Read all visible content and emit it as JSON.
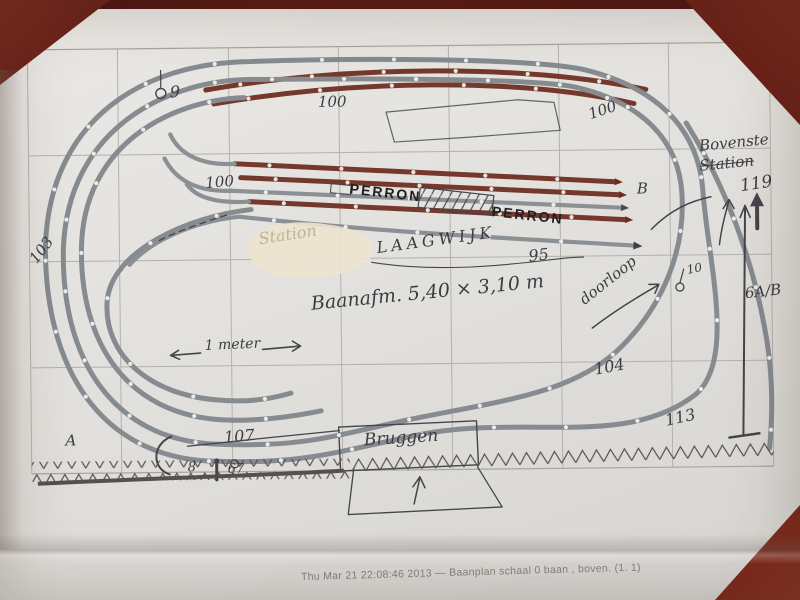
{
  "caption": "Thu Mar 21 22:08:46 2013 — Baanplan schaal 0 baan , boven. (1. 1)",
  "colors": {
    "table_surface": "#6b2015",
    "paper": "#e3e1dd",
    "track_gray": "#868b90",
    "track_brown": "#74392c",
    "pencil": "#44444a",
    "grid": "#b3b1ac"
  },
  "labels": {
    "perron_left": "PERRON",
    "perron_right": "PERRON",
    "laagwijk": "LAAGWIJK",
    "erased": "Station",
    "baanafm": "Baanafm. 5,40 × 3,10 m",
    "meter": "1 meter",
    "bovenste": "Bovenste",
    "station": "Station",
    "doorloop": "doorloop",
    "bruggen": "Bruggen",
    "n9": "9",
    "n10": "10",
    "n8": "8",
    "n67": "67",
    "n100_top": "100",
    "n100_top_right": "100",
    "n100_mid_left": "100",
    "n95": "95",
    "n103": "103",
    "n104": "104",
    "n107": "107",
    "n113": "113",
    "n119": "119",
    "n6ab": "6A/B",
    "a": "A",
    "b": "B"
  }
}
